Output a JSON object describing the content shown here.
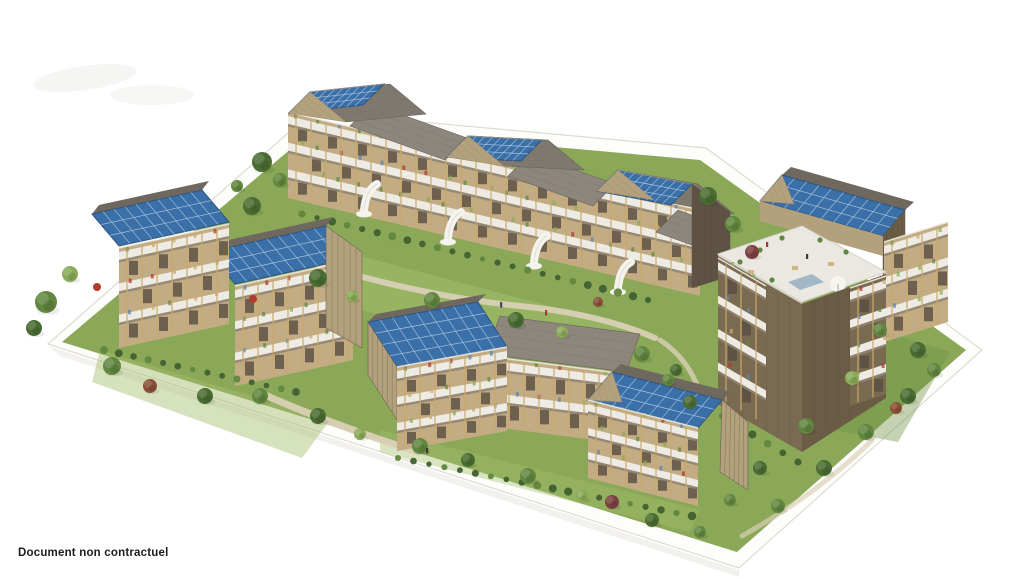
{
  "caption": "Document non contractuel",
  "scene": {
    "type": "3d-architectural-rendering",
    "subject": "aerial view of a timber residential eco-district model",
    "solar_roof_arrays": 8,
    "features": [
      "rooftop solar panels",
      "wood balcony facades",
      "white spiral staircases",
      "rooftop terrace with people and parasol",
      "gardens with trees and hedges",
      "white model base board"
    ]
  },
  "colors": {
    "background": "#ffffff",
    "caption": "#1d1d1d",
    "smudge": "#f5f5f3",
    "platform": "#fdfdfb",
    "platform_edge": "#dedbd2",
    "platform_shadow": "#efeeea",
    "grass": "#8aa857",
    "grass_light": "#a3bd6c",
    "grass_dark": "#6d9046",
    "path": "#d9d0b5",
    "solar": "#3a6fa8",
    "solar_grid": "#a9c3de",
    "solar_border": "#2c5581",
    "roof": "#7f786e",
    "roof_light": "#8d867c",
    "roof_dark": "#6f685f",
    "roof_line": "#6b645b",
    "wood": "#c3ac84",
    "wood_gable": "#b3a07d",
    "wood_post": "#c9a96b",
    "wood_dark": "#7a6a52",
    "wood_lattice": "#6b5c46",
    "railing": "#edebe3",
    "railing_shadow": "#8f8472",
    "window": "#574d41",
    "terrace": "#eae8e0",
    "terrace_edge": "#d6d3c8",
    "stair": "#f4f3ee",
    "tree_dark": "#4a6c33",
    "tree_mid": "#61873f",
    "tree_light": "#8aab58",
    "tree_red": "#8a4f38",
    "tree_red2": "#7c4040",
    "hedge": "#40602f",
    "umbrella": "#b23b30",
    "parasol": "#f6f5f0",
    "accent_blue": "#5b87ae",
    "person_dark": "#3f3a33",
    "person_red": "#a33b2f",
    "person_blue": "#3f4a63"
  }
}
